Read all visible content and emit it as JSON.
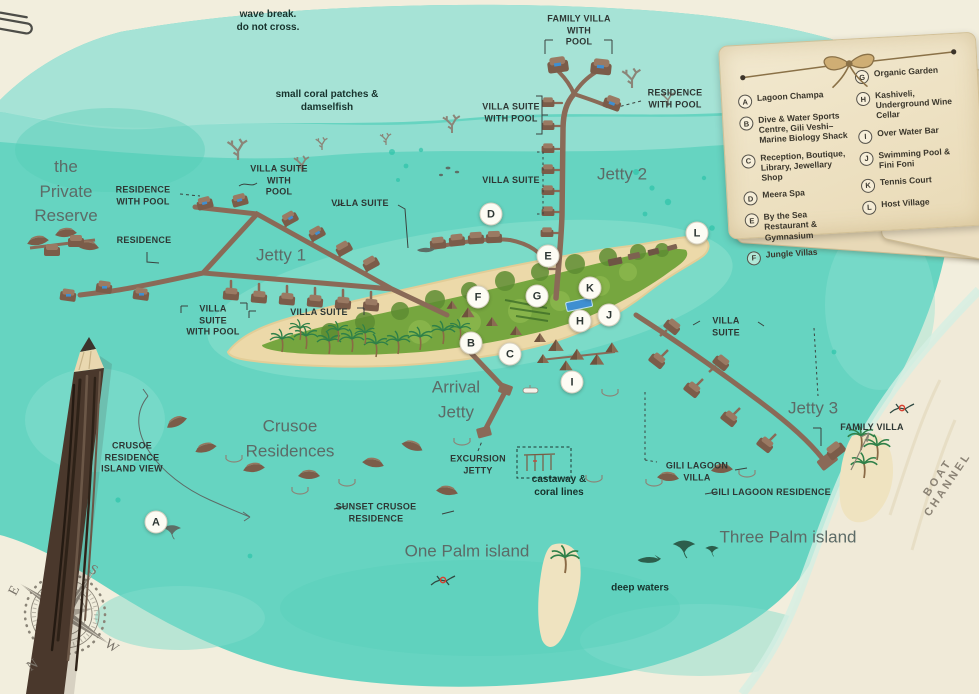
{
  "map_title": "Resort island map",
  "labels": {
    "wave_break": "wave break.\ndo not cross.",
    "coral_patches": "small coral patches &\ndamselfish",
    "private_reserve": "the\nPrivate\nReserve",
    "residence_with_pool_w": "RESIDENCE\nWITH POOL",
    "villa_suite_with_pool_n": "VILLA SUITE\nWITH\nPOOL",
    "villa_suite_ne": "VILLA SUITE",
    "residence_w": "RESIDENCE",
    "jetty1": "Jetty 1",
    "villa_suite_with_pool_sw": "VILLA\nSUITE\nWITH POOL",
    "villa_suite_s": "VILLA SUITE",
    "family_villa_with_pool": "FAMILY VILLA\nWITH\nPOOL",
    "villa_suite_with_pool_j2": "VILLA SUITE\nWITH POOL",
    "residence_with_pool_j2": "RESIDENCE\nWITH POOL",
    "villa_suite_j2": "VILLA SUITE",
    "jetty2": "Jetty 2",
    "villa_suite_j3": "VILLA\nSUITE",
    "jetty3": "Jetty 3",
    "family_villa": "FAMILY VILLA",
    "arrival_jetty": "Arrival\nJetty",
    "excursion_jetty": "EXCURSION\nJETTY",
    "castaway": "castaway &\ncoral lines",
    "gili_lagoon_villa": "GILI LAGOON\nVILLA",
    "gili_lagoon_residence": "GILI LAGOON RESIDENCE",
    "crusoe_island_view": "CRUSOE\nRESIDENCE\nISLAND VIEW",
    "crusoe_residences": "Crusoe\nResidences",
    "sunset_crusoe": "SUNSET CRUSOE\nRESIDENCE",
    "one_palm": "One Palm island",
    "three_palm": "Three Palm island",
    "deep_waters": "deep waters",
    "boat_channel": "BOAT CHANNEL"
  },
  "markers": [
    {
      "letter": "A"
    },
    {
      "letter": "B"
    },
    {
      "letter": "C"
    },
    {
      "letter": "D"
    },
    {
      "letter": "E"
    },
    {
      "letter": "F"
    },
    {
      "letter": "G"
    },
    {
      "letter": "H"
    },
    {
      "letter": "I"
    },
    {
      "letter": "J"
    },
    {
      "letter": "K"
    },
    {
      "letter": "L"
    }
  ],
  "legend": {
    "columns": [
      {
        "items": [
          {
            "letter": "A",
            "label": "Lagoon Champa"
          },
          {
            "letter": "B",
            "label": "Dive & Water Sports\nCentre, Gili Veshi–\nMarine Biology Shack"
          },
          {
            "letter": "C",
            "label": "Reception, Boutique,\nLibrary, Jewellary Shop"
          },
          {
            "letter": "D",
            "label": "Meera Spa"
          },
          {
            "letter": "E",
            "label": "By the Sea Restaurant &\nGymnasium"
          },
          {
            "letter": "F",
            "label": "Jungle Villas"
          }
        ]
      },
      {
        "items": [
          {
            "letter": "G",
            "label": "Organic Garden"
          },
          {
            "letter": "H",
            "label": "Kashiveli,\nUnderground Wine Cellar"
          },
          {
            "letter": "I",
            "label": "Over Water Bar"
          },
          {
            "letter": "J",
            "label": "Swimming Pool &\nFini Foni"
          },
          {
            "letter": "K",
            "label": "Tennis Court"
          },
          {
            "letter": "L",
            "label": "Host Village"
          }
        ]
      }
    ]
  },
  "compass": {
    "n": "N",
    "s": "S",
    "e": "E",
    "w": "W"
  },
  "colors": {
    "water": "#66d4c1",
    "water_light": "#abe4d8",
    "sand_bg": "#f2eedd",
    "island_green": "#76a63f",
    "beach": "#ecd9a9",
    "jetty": "#8a6a57",
    "pool_blue": "#3f8fd1",
    "label_dark": "#2e3734",
    "label_gray": "#5c6b67",
    "paper": "#efe5c9",
    "accent_red": "#d8402f"
  }
}
